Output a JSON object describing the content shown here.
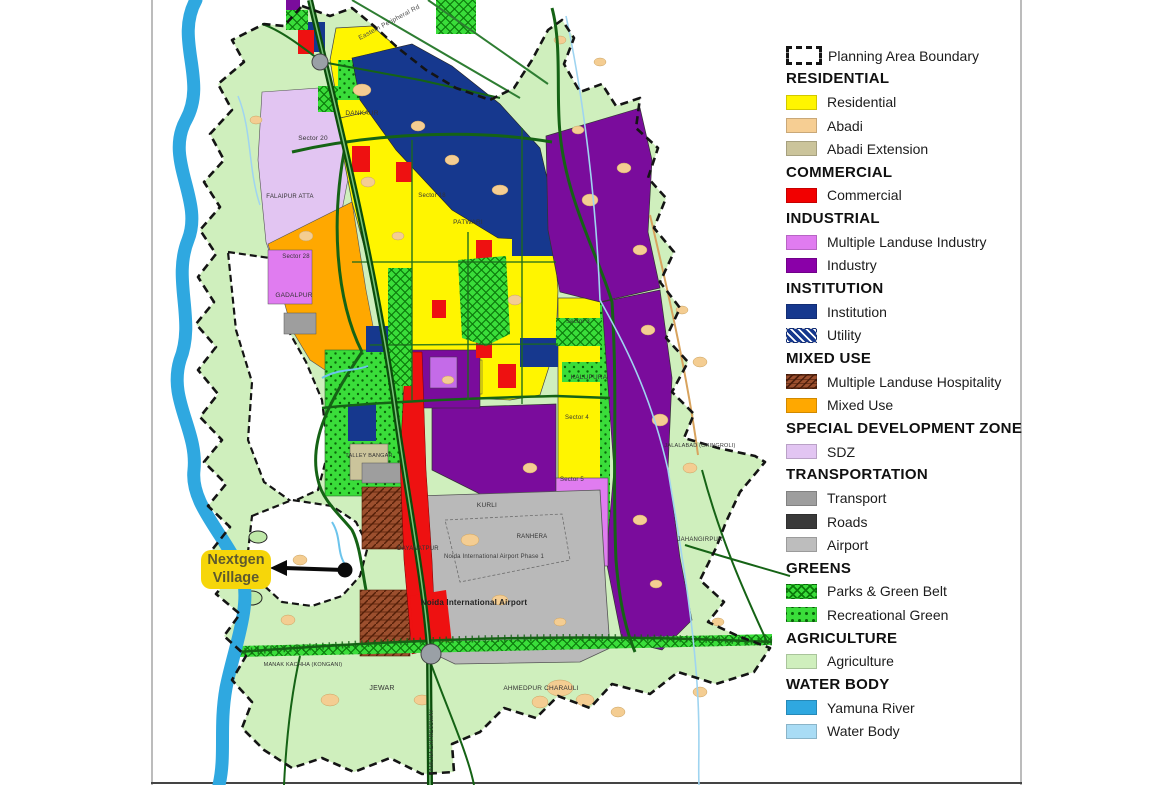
{
  "annotation": {
    "line1": "Nextgen",
    "line2": "Village",
    "bg_color": "#F6D60A",
    "text_color": "#5E5A2E"
  },
  "legend": {
    "boundary": {
      "label": "Planning Area Boundary"
    },
    "sections": [
      {
        "header": "RESIDENTIAL",
        "items": [
          {
            "label": "Residential",
            "color": "#FFF500",
            "pattern": "solid"
          },
          {
            "label": "Abadi",
            "color": "#F6CE93",
            "pattern": "solid"
          },
          {
            "label": "Abadi Extension",
            "color": "#CBC49B",
            "pattern": "solid"
          }
        ]
      },
      {
        "header": "COMMERCIAL",
        "items": [
          {
            "label": "Commercial",
            "color": "#F20000",
            "pattern": "solid"
          }
        ]
      },
      {
        "header": "INDUSTRIAL",
        "items": [
          {
            "label": "Multiple Landuse Industry",
            "color": "#E07CF0",
            "pattern": "solid"
          },
          {
            "label": "Industry",
            "color": "#8A00A8",
            "pattern": "solid"
          }
        ]
      },
      {
        "header": "INSTITUTION",
        "items": [
          {
            "label": "Institution",
            "color": "#16388E",
            "pattern": "solid"
          },
          {
            "label": "Utility",
            "color": "#16388E",
            "pattern": "diagonal-hatch"
          }
        ]
      },
      {
        "header": "MIXED USE",
        "items": [
          {
            "label": "Multiple Landuse Hospitality",
            "color": "#9C4F2E",
            "pattern": "brick-hatch"
          },
          {
            "label": "Mixed Use",
            "color": "#FFA800",
            "pattern": "solid"
          }
        ]
      },
      {
        "header": "SPECIAL DEVELOPMENT ZONE",
        "items": [
          {
            "label": "SDZ",
            "color": "#E2C5F2",
            "pattern": "solid"
          }
        ]
      },
      {
        "header": "TRANSPORTATION",
        "items": [
          {
            "label": "Transport",
            "color": "#9E9E9E",
            "pattern": "solid"
          },
          {
            "label": "Roads",
            "color": "#3A3A3A",
            "pattern": "solid"
          },
          {
            "label": "Airport",
            "color": "#BDBDBD",
            "pattern": "solid"
          }
        ]
      },
      {
        "header": "GREENS",
        "items": [
          {
            "label": "Parks & Green Belt",
            "color": "#3ADD3A",
            "pattern": "crosshatch"
          },
          {
            "label": "Recreational Green",
            "color": "#3ADD3A",
            "pattern": "dots"
          }
        ]
      },
      {
        "header": "AGRICULTURE",
        "items": [
          {
            "label": "Agriculture",
            "color": "#CFEFBD",
            "pattern": "solid"
          }
        ]
      },
      {
        "header": "WATER BODY",
        "items": [
          {
            "label": "Yamuna River",
            "color": "#2FA8E0",
            "pattern": "solid"
          },
          {
            "label": "Water Body",
            "color": "#A9DCF5",
            "pattern": "solid"
          }
        ]
      }
    ]
  },
  "map_labels": [
    {
      "t": "DANKAUR",
      "x": 362,
      "y": 115,
      "s": 6.5
    },
    {
      "t": "Sector 20",
      "x": 313,
      "y": 140,
      "s": 6.5
    },
    {
      "t": "FALAIPUR ATTA",
      "x": 290,
      "y": 198,
      "s": 6
    },
    {
      "t": "Sector 28",
      "x": 296,
      "y": 258,
      "s": 6
    },
    {
      "t": "GADALPUR",
      "x": 294,
      "y": 297,
      "s": 6.5
    },
    {
      "t": "Sector 18",
      "x": 432,
      "y": 197,
      "s": 6
    },
    {
      "t": "PATWARI",
      "x": 468,
      "y": 224,
      "s": 6.5
    },
    {
      "t": "TALLEY BANGAR",
      "x": 369,
      "y": 457,
      "s": 5.5
    },
    {
      "t": "KURLI",
      "x": 487,
      "y": 507,
      "s": 6.5
    },
    {
      "t": "DAYANATPUR",
      "x": 418,
      "y": 550,
      "s": 6
    },
    {
      "t": "RANHERA",
      "x": 532,
      "y": 538,
      "s": 6
    },
    {
      "t": "Noida International Airport Phase 1",
      "x": 494,
      "y": 558,
      "s": 6,
      "c": "#3a3a3a"
    },
    {
      "t": "Noida International Airport",
      "x": 474,
      "y": 605,
      "s": 8,
      "w": 700,
      "c": "#222222"
    },
    {
      "t": "KALUPURA",
      "x": 589,
      "y": 379,
      "s": 6.5
    },
    {
      "t": "Sector 3",
      "x": 578,
      "y": 323,
      "s": 6
    },
    {
      "t": "Sector 4",
      "x": 577,
      "y": 419,
      "s": 6
    },
    {
      "t": "Sector 5",
      "x": 572,
      "y": 481,
      "s": 6
    },
    {
      "t": "JEWAR",
      "x": 382,
      "y": 690,
      "s": 7
    },
    {
      "t": "MANAK KACHHA (KONGANI)",
      "x": 303,
      "y": 666,
      "s": 5.5
    },
    {
      "t": "AHMEDPUR CHARAULI",
      "x": 541,
      "y": 690,
      "s": 6.5
    },
    {
      "t": "JAHANGIRPUR",
      "x": 700,
      "y": 541,
      "s": 6
    },
    {
      "t": "JALALABAD (CHINGROLI)",
      "x": 700,
      "y": 447,
      "s": 5.5
    },
    {
      "t": "Eastern Peripheral Rd",
      "x": 390,
      "y": 24,
      "s": 6.5,
      "rot": -28,
      "c": "#4a4a4a"
    },
    {
      "t": "YAMUNA EXPRESSWAY",
      "x": 433,
      "y": 742,
      "s": 5.5,
      "rot": -90,
      "c": "#333333"
    }
  ]
}
